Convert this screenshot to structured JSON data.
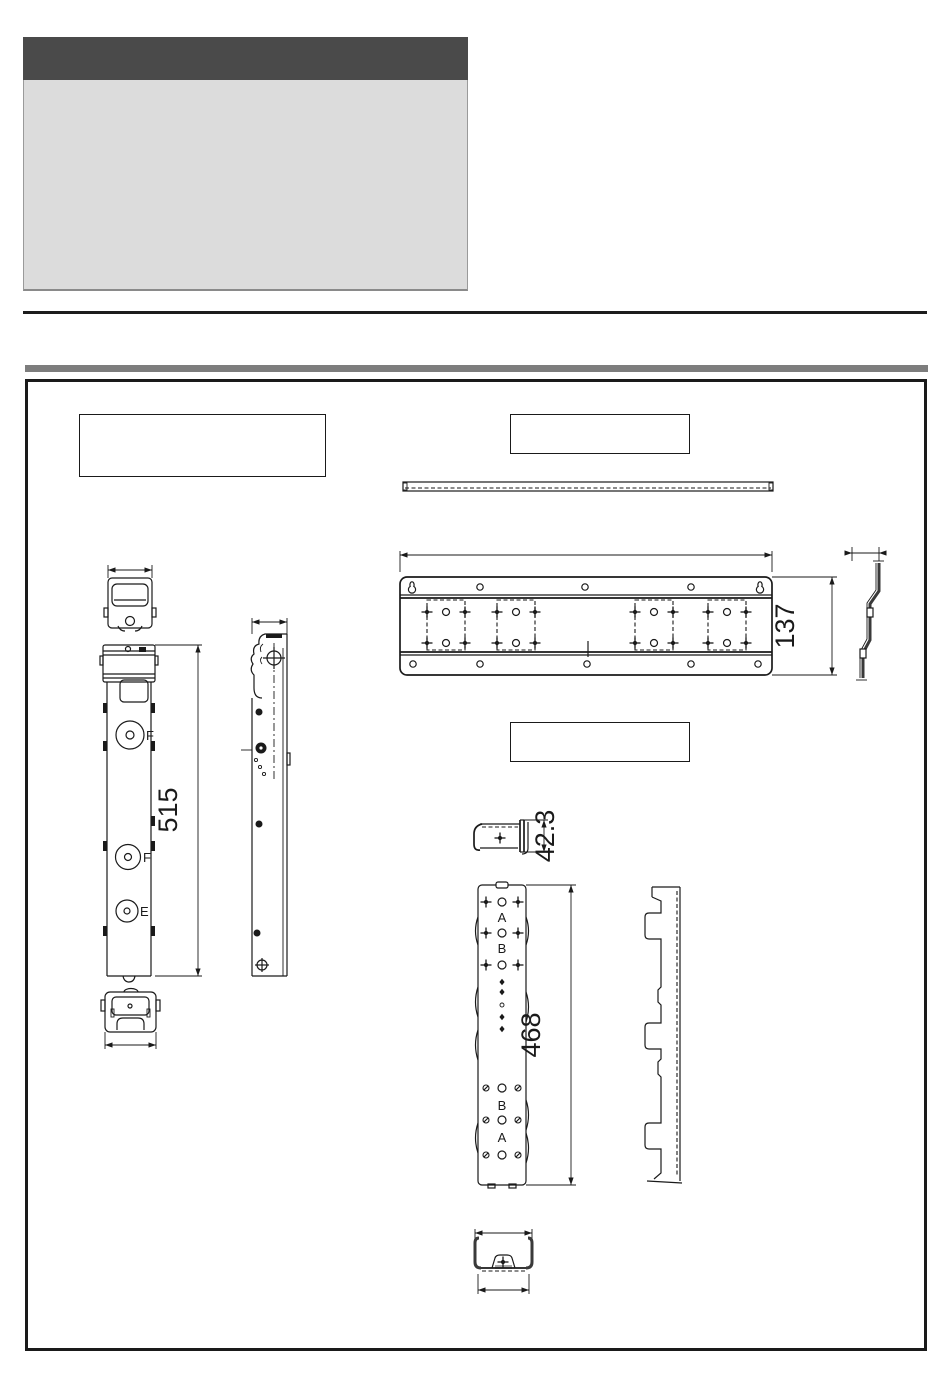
{
  "colors": {
    "header_bar": "#4a4a4a",
    "header_panel": "#dcdcdc",
    "section_divider": "#7d7d7d",
    "line_work": "#1a1a1a",
    "background": "#ffffff"
  },
  "callouts": {
    "left": "",
    "right_top": "",
    "right_middle": ""
  },
  "drawings": {
    "left_bracket": {
      "height_dim": "515",
      "hole_label_f1": "F",
      "hole_label_f2": "F",
      "hole_label_e": "E"
    },
    "wall_plate": {
      "height_dim": "137"
    },
    "hook_spacer": {
      "height_dim": "42.3"
    },
    "vertical_rail": {
      "height_dim": "468",
      "label_a_top": "A",
      "label_b_top": "B",
      "label_b_bottom": "B",
      "label_a_bottom": "A"
    }
  }
}
